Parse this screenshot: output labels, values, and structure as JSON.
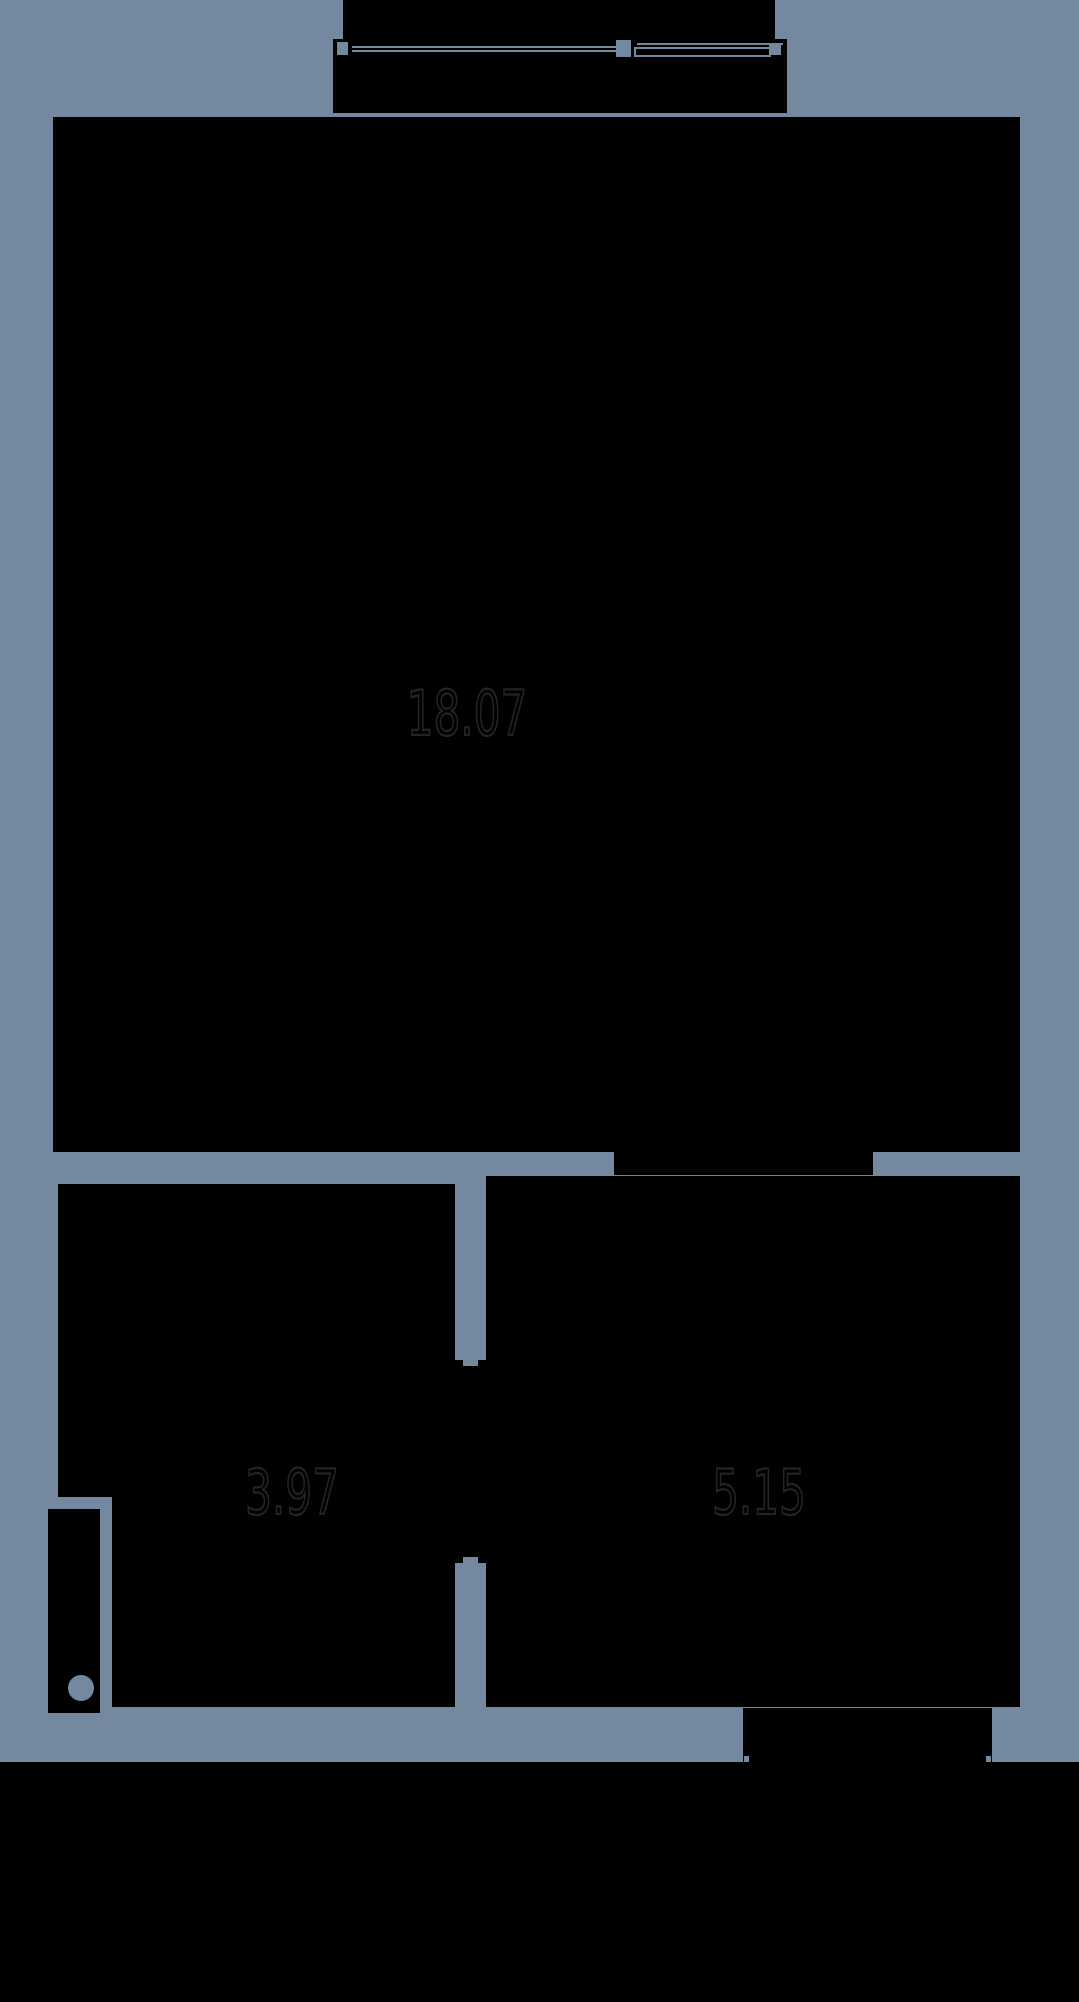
{
  "colors": {
    "background": "#74889F",
    "room_fill": "#000000",
    "label_outline": "#242424"
  },
  "rooms": {
    "main": {
      "label": "18.07"
    },
    "bottom_left": {
      "label": "3.97"
    },
    "bottom_right": {
      "label": "5.15"
    }
  }
}
